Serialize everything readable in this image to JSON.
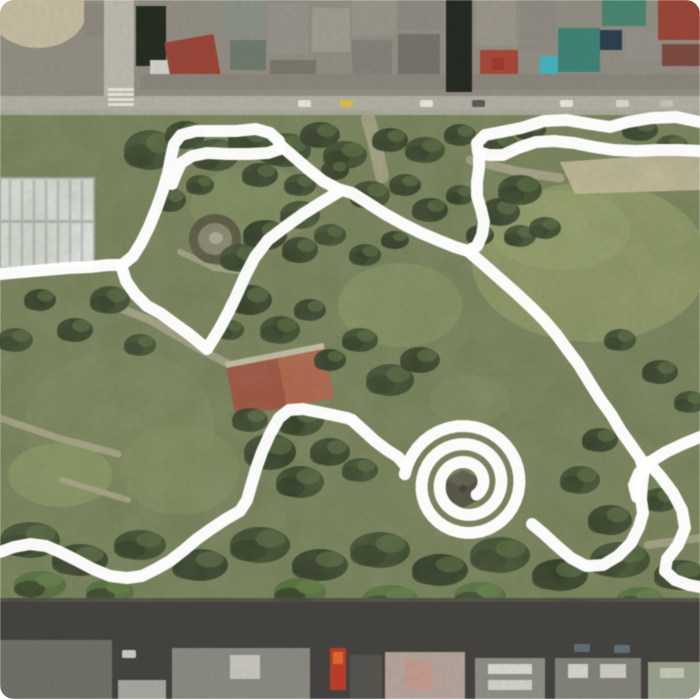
{
  "canvas": {
    "width": 700,
    "height": 699
  },
  "view": {
    "kind": "satellite-map-with-route-overlay",
    "visible_text": ""
  },
  "palette": {
    "trace_color": "#ffffff",
    "park_base": "#76815a",
    "lawn": "#8d9865",
    "lawn_bright": "#95a06b",
    "tree_dark": "#35432a",
    "tree_darker": "#2a3622",
    "tree_bright": "#4e6b38",
    "dirt_path": "#b3ab93",
    "sand_strip": "#c7bc9e",
    "city_base_north": "#938d83",
    "road_north": "#b3afa5",
    "road_south": "#454240",
    "shadow_band": "#23281f",
    "hall_roof": "#e7eae9",
    "clay_court": "#a34c3b",
    "clay_court_light": "#b86048",
    "pond_ring": "#55523f",
    "pond_inner": "#8d8672",
    "pond_center": "#b9b2a2",
    "pavilion": "#474038",
    "roof_red": "#9a4538",
    "roof_teal": "#3f8376",
    "roof_cyan": "#44b3c2",
    "roof_green": "#49856f",
    "roof_navy": "#2e3e52",
    "truck_red": "#c03b28"
  },
  "trace": {
    "color": "#ffffff",
    "width": 12,
    "opacity": 0.97,
    "strokes": [
      {
        "name": "west-approach",
        "type": "polyline",
        "points": [
          [
            0,
            274
          ],
          [
            22,
            272
          ],
          [
            45,
            270
          ],
          [
            68,
            268
          ],
          [
            90,
            267
          ],
          [
            108,
            265
          ],
          [
            122,
            265
          ]
        ]
      },
      {
        "name": "northwest-loop",
        "type": "polyline",
        "points": [
          [
            122,
            265
          ],
          [
            133,
            256
          ],
          [
            141,
            243
          ],
          [
            149,
            227
          ],
          [
            157,
            207
          ],
          [
            163,
            190
          ],
          [
            168,
            173
          ],
          [
            171,
            157
          ],
          [
            174,
            144
          ],
          [
            181,
            135
          ],
          [
            196,
            131
          ],
          [
            215,
            131
          ],
          [
            236,
            131
          ],
          [
            256,
            129
          ],
          [
            270,
            133
          ],
          [
            279,
            141
          ],
          [
            280,
            149
          ],
          [
            268,
            153
          ],
          [
            249,
            154
          ],
          [
            228,
            154
          ],
          [
            207,
            153
          ],
          [
            192,
            156
          ],
          [
            181,
            163
          ],
          [
            176,
            174
          ],
          [
            172,
            184
          ]
        ]
      },
      {
        "name": "loop-east-link",
        "type": "polyline",
        "points": [
          [
            279,
            144
          ],
          [
            293,
            156
          ],
          [
            308,
            169
          ],
          [
            323,
            181
          ],
          [
            338,
            189
          ],
          [
            352,
            193
          ],
          [
            368,
            203
          ],
          [
            385,
            214
          ],
          [
            403,
            224
          ],
          [
            421,
            233
          ],
          [
            440,
            241
          ],
          [
            455,
            247
          ],
          [
            468,
            251
          ]
        ]
      },
      {
        "name": "zigzag-southwest",
        "type": "polyline",
        "points": [
          [
            340,
            191
          ],
          [
            322,
            202
          ],
          [
            303,
            214
          ],
          [
            285,
            227
          ],
          [
            268,
            240
          ],
          [
            255,
            257
          ],
          [
            246,
            274
          ],
          [
            238,
            292
          ],
          [
            229,
            311
          ],
          [
            220,
            328
          ],
          [
            212,
            341
          ],
          [
            207,
            349
          ],
          [
            201,
            344
          ],
          [
            189,
            334
          ],
          [
            175,
            324
          ],
          [
            160,
            313
          ],
          [
            147,
            306
          ],
          [
            135,
            294
          ],
          [
            126,
            281
          ],
          [
            122,
            268
          ]
        ]
      },
      {
        "name": "north-hairpin",
        "type": "polyline",
        "points": [
          [
            700,
            122
          ],
          [
            676,
            117
          ],
          [
            652,
            118
          ],
          [
            628,
            122
          ],
          [
            610,
            127
          ],
          [
            590,
            124
          ],
          [
            567,
            120
          ],
          [
            544,
            121
          ],
          [
            521,
            128
          ],
          [
            501,
            132
          ],
          [
            485,
            135
          ],
          [
            477,
            143
          ],
          [
            478,
            152
          ],
          [
            489,
            155
          ],
          [
            503,
            155
          ],
          [
            518,
            148
          ],
          [
            536,
            142
          ],
          [
            554,
            141
          ],
          [
            574,
            143
          ],
          [
            594,
            147
          ],
          [
            614,
            150
          ],
          [
            636,
            151
          ],
          [
            658,
            150
          ],
          [
            680,
            150
          ],
          [
            700,
            151
          ]
        ]
      },
      {
        "name": "descent-to-junction",
        "type": "polyline",
        "points": [
          [
            479,
            155
          ],
          [
            479,
            168
          ],
          [
            477,
            182
          ],
          [
            477,
            196
          ],
          [
            481,
            209
          ],
          [
            484,
            222
          ],
          [
            482,
            235
          ],
          [
            477,
            246
          ],
          [
            468,
            251
          ]
        ]
      },
      {
        "name": "main-southeast",
        "type": "polyline",
        "points": [
          [
            468,
            251
          ],
          [
            482,
            263
          ],
          [
            499,
            278
          ],
          [
            516,
            293
          ],
          [
            531,
            307
          ],
          [
            544,
            320
          ],
          [
            556,
            334
          ],
          [
            567,
            349
          ],
          [
            579,
            365
          ],
          [
            590,
            383
          ],
          [
            600,
            399
          ],
          [
            611,
            414
          ],
          [
            621,
            431
          ],
          [
            631,
            445
          ],
          [
            640,
            458
          ],
          [
            644,
            470
          ],
          [
            642,
            484
          ],
          [
            641,
            499
          ],
          [
            643,
            513
          ],
          [
            639,
            527
          ],
          [
            631,
            543
          ],
          [
            618,
            556
          ],
          [
            603,
            565
          ],
          [
            586,
            566
          ],
          [
            571,
            558
          ],
          [
            557,
            546
          ],
          [
            544,
            534
          ],
          [
            532,
            524
          ]
        ]
      },
      {
        "name": "south-wavy",
        "type": "polyline",
        "points": [
          [
            0,
            552
          ],
          [
            14,
            547
          ],
          [
            30,
            544
          ],
          [
            46,
            546
          ],
          [
            60,
            552
          ],
          [
            76,
            560
          ],
          [
            93,
            569
          ],
          [
            110,
            576
          ],
          [
            127,
            578
          ],
          [
            142,
            576
          ],
          [
            156,
            569
          ],
          [
            170,
            561
          ],
          [
            184,
            550
          ],
          [
            197,
            539
          ],
          [
            211,
            529
          ],
          [
            226,
            519
          ],
          [
            240,
            511
          ],
          [
            247,
            500
          ],
          [
            251,
            486
          ],
          [
            256,
            469
          ],
          [
            262,
            452
          ],
          [
            270,
            434
          ],
          [
            279,
            418
          ],
          [
            289,
            410
          ],
          [
            303,
            409
          ],
          [
            318,
            412
          ],
          [
            333,
            415
          ],
          [
            347,
            418
          ],
          [
            352,
            420
          ]
        ]
      },
      {
        "name": "spiral-entry",
        "type": "polyline",
        "points": [
          [
            352,
            420
          ],
          [
            363,
            430
          ],
          [
            375,
            441
          ],
          [
            387,
            450
          ],
          [
            398,
            457
          ],
          [
            405,
            465
          ]
        ]
      },
      {
        "name": "center-spiral",
        "type": "spiral",
        "cx": 466,
        "cy": 484,
        "r_outer": 62,
        "r_inner": 15,
        "turns": 2.6,
        "start_angle_rad": 3.3
      },
      {
        "name": "east-cross",
        "type": "polyline",
        "points": [
          [
            700,
            437
          ],
          [
            683,
            444
          ],
          [
            666,
            452
          ],
          [
            650,
            462
          ],
          [
            639,
            473
          ],
          [
            634,
            485
          ],
          [
            637,
            497
          ]
        ]
      },
      {
        "name": "east-hook",
        "type": "polyline",
        "points": [
          [
            648,
            462
          ],
          [
            661,
            477
          ],
          [
            673,
            493
          ],
          [
            682,
            510
          ],
          [
            685,
            528
          ],
          [
            678,
            545
          ],
          [
            667,
            559
          ],
          [
            665,
            571
          ],
          [
            675,
            580
          ],
          [
            689,
            585
          ],
          [
            700,
            587
          ]
        ]
      }
    ]
  }
}
